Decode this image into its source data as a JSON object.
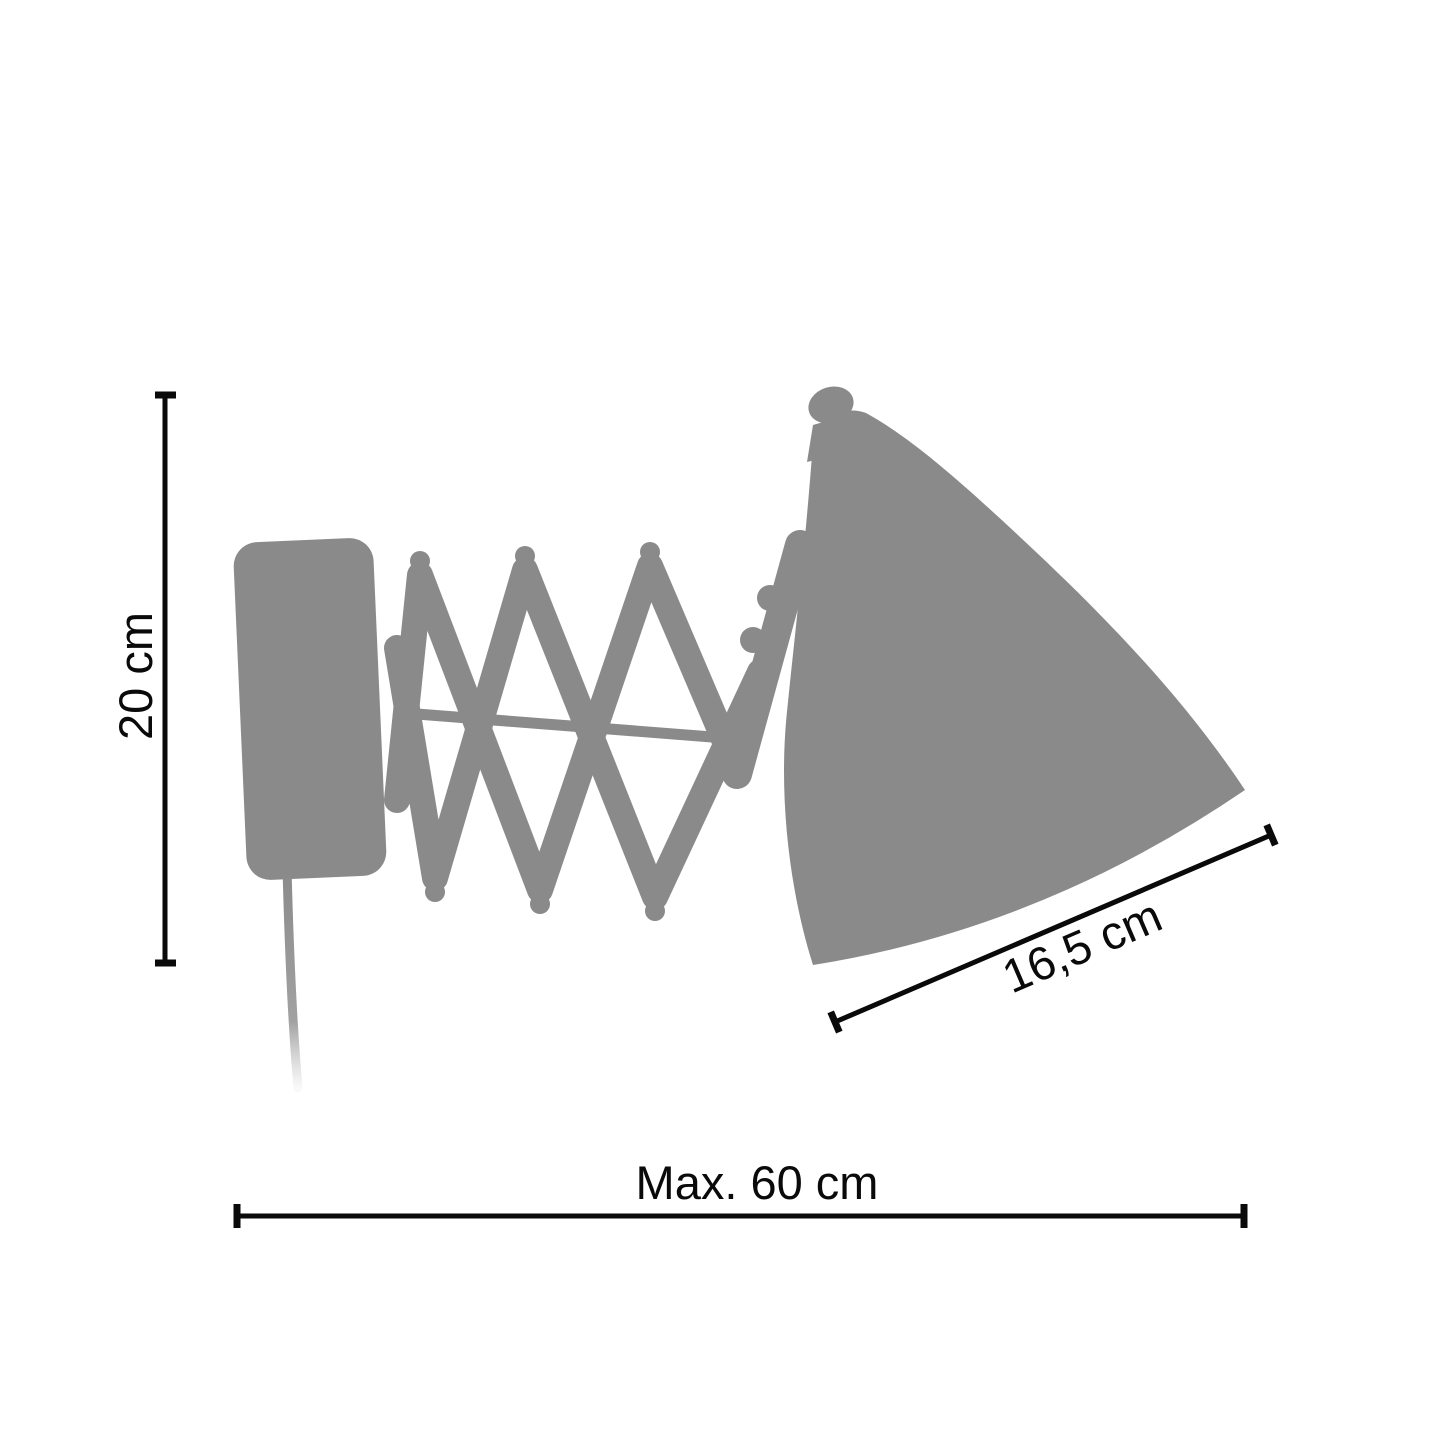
{
  "diagram": {
    "subject": "wall-mounted scissor-arm lamp silhouette with measurements"
  },
  "dimensions": {
    "height": {
      "label": "20 cm",
      "orientation": "vertical"
    },
    "shade_diameter": {
      "label": "16,5 cm",
      "orientation": "diagonal"
    },
    "max_extension": {
      "label": "Max. 60 cm",
      "orientation": "horizontal"
    }
  },
  "colors": {
    "silhouette": "#8a8a8a",
    "dimension_lines": "#0a0a0a",
    "background": "#ffffff"
  }
}
